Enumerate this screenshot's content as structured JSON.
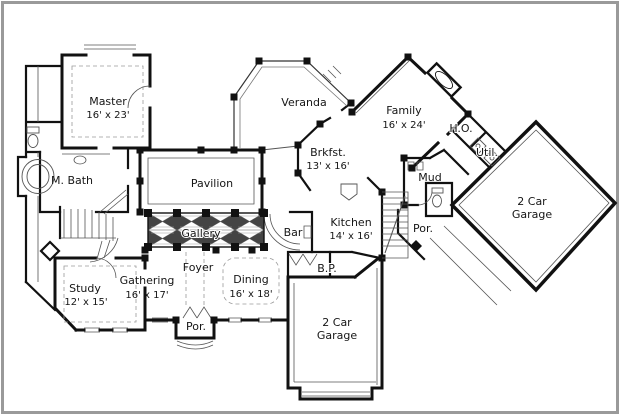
{
  "colors": {
    "wall": "#111111",
    "detail": "#555555",
    "light_line": "#999999",
    "frame": "#9a9a9a",
    "background": "#ffffff",
    "coffer_fill": "#444444"
  },
  "rooms": {
    "master": {
      "label": "Master",
      "dims": "16' x 23'"
    },
    "master_bath": {
      "label": "M. Bath"
    },
    "veranda": {
      "label": "Veranda"
    },
    "family": {
      "label": "Family",
      "dims": "16' x 24'"
    },
    "home_office": {
      "label": "H.O."
    },
    "utility": {
      "label": "Util."
    },
    "mud": {
      "label": "Mud"
    },
    "breakfast": {
      "label": "Brkfst.",
      "dims": "13' x 16'"
    },
    "pavilion": {
      "label": "Pavilion"
    },
    "gallery": {
      "label": "Gallery"
    },
    "bar": {
      "label": "Bar"
    },
    "kitchen": {
      "label": "Kitchen",
      "dims": "14' x 16'"
    },
    "porch_rear": {
      "label": "Por."
    },
    "garage_right": {
      "label_line1": "2 Car",
      "label_line2": "Garage"
    },
    "foyer": {
      "label": "Foyer"
    },
    "dining": {
      "label": "Dining",
      "dims": "16' x 18'"
    },
    "butlers_pantry": {
      "label": "B.P."
    },
    "gathering": {
      "label": "Gathering",
      "dims": "16' x 17'"
    },
    "study": {
      "label": "Study",
      "dims": "12' x 15'"
    },
    "porch_front": {
      "label": "Por."
    },
    "garage_bottom": {
      "label_line1": "2 Car",
      "label_line2": "Garage"
    }
  }
}
